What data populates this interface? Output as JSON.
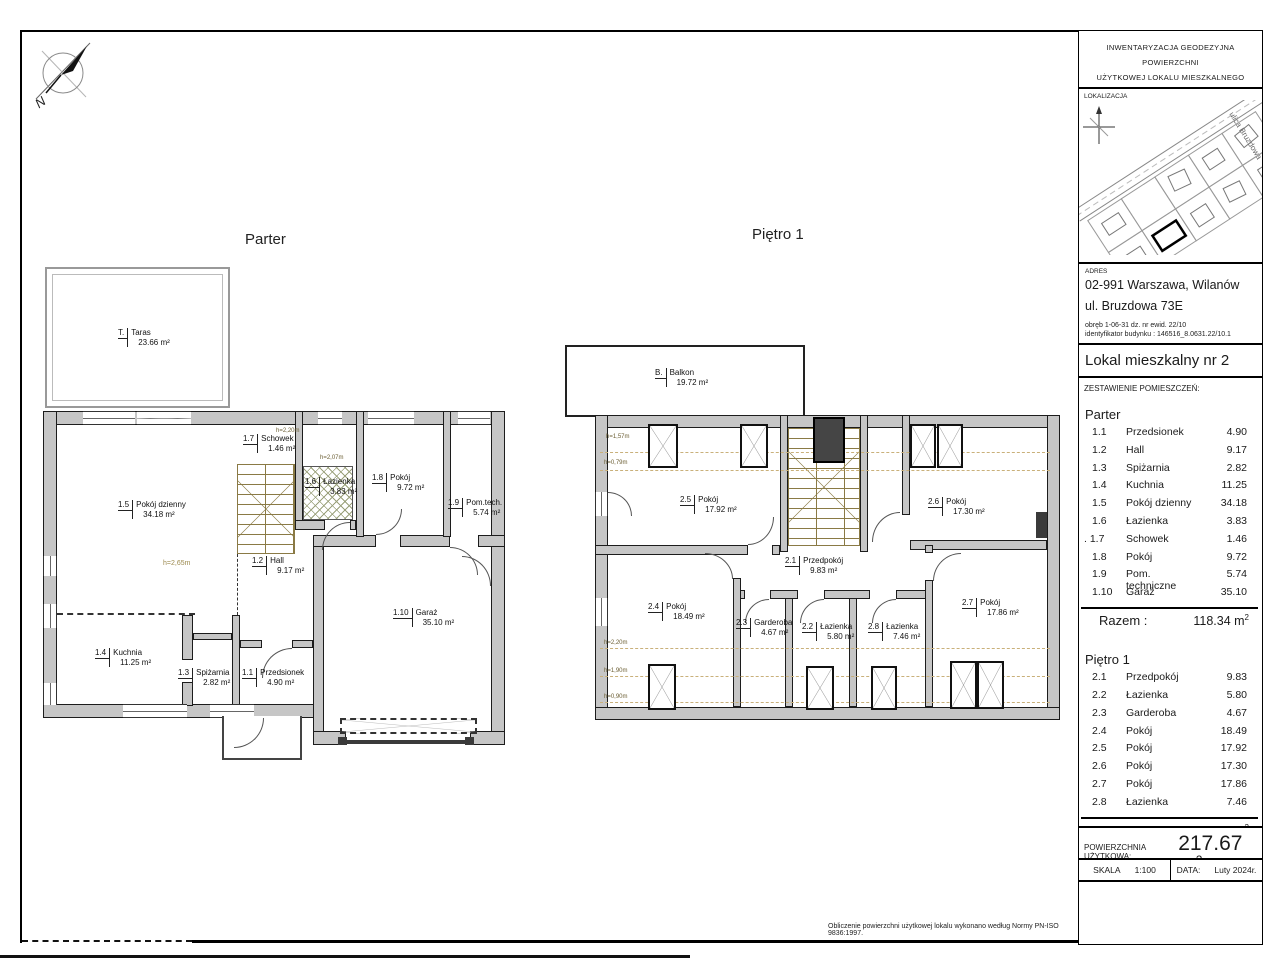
{
  "panel": {
    "header": {
      "line1": "INWENTARYZACJA GEODEZYJNA POWIERZCHNI",
      "line2": "UŻYTKOWEJ LOKALU MIESZKALNEGO"
    },
    "lokalizacja": {
      "label": "LOKALIZACJA",
      "street": "ulica Bruzdowa"
    },
    "adres": {
      "label": "ADRES",
      "city": "02-991 Warszawa, Wilanów",
      "street": "ul. Bruzdowa 73E",
      "obreb": "obręb 1-06-31 dz. nr ewid. 22/10",
      "building_id": "identyfikator budynku : 146516_8.0631.22/10.1"
    },
    "unit": {
      "label": "Lokal mieszkalny nr  2"
    },
    "rooms_summary": {
      "label": "ZESTAWIENIE POMIESZCZEŃ:",
      "floors": [
        {
          "name": "Parter",
          "razem_label": "Razem :",
          "razem_value": "118.34 m",
          "razem_sup": "2",
          "rooms": [
            {
              "num": "1.1",
              "name": "Przedsionek",
              "area": "4.90"
            },
            {
              "num": "1.2",
              "name": "Hall",
              "area": "9.17"
            },
            {
              "num": "1.3",
              "name": "Spiżarnia",
              "area": "2.82"
            },
            {
              "num": "1.4",
              "name": "Kuchnia",
              "area": "11.25"
            },
            {
              "num": "1.5",
              "name": "Pokój dzienny",
              "area": "34.18"
            },
            {
              "num": "1.6",
              "name": "Łazienka",
              "area": "3.83"
            },
            {
              "num": ". 1.7",
              "name": "Schowek",
              "area": "1.46"
            },
            {
              "num": "1.8",
              "name": "Pokój",
              "area": "9.72"
            },
            {
              "num": "1.9",
              "name": "Pom. techniczne",
              "area": "5.74"
            },
            {
              "num": "1.10",
              "name": "Garaż",
              "area": "35.10"
            }
          ]
        },
        {
          "name": "Piętro 1",
          "razem_label": "Razem :",
          "razem_value": "99.33 m",
          "razem_sup": "2",
          "rooms": [
            {
              "num": "2.1",
              "name": "Przedpokój",
              "area": "9.83"
            },
            {
              "num": "2.2",
              "name": "Łazienka",
              "area": "5.80"
            },
            {
              "num": "2.3",
              "name": "Garderoba",
              "area": "4.67"
            },
            {
              "num": "2.4",
              "name": "Pokój",
              "area": "18.49"
            },
            {
              "num": "2.5",
              "name": "Pokój",
              "area": "17.92"
            },
            {
              "num": "2.6",
              "name": "Pokój",
              "area": "17.30"
            },
            {
              "num": "2.7",
              "name": "Pokój",
              "area": "17.86"
            },
            {
              "num": "2.8",
              "name": "Łazienka",
              "area": "7.46"
            }
          ]
        }
      ]
    },
    "total": {
      "label": "POWIERZCHNIA UŻYTKOWA:",
      "value": "217.67 m",
      "sup": "2"
    },
    "meta": {
      "skala_label": "SKALA",
      "skala_value": "1:100",
      "data_label": "DATA:",
      "data_value": "Luty 2024r."
    }
  },
  "note": "Obliczenie powierzchni użytkowej lokalu wykonano według Normy PN-ISO 9836:1997.",
  "compass": {
    "n": "N"
  },
  "plans": {
    "parter": {
      "title": "Parter",
      "labels": [
        {
          "num": "T.",
          "name": "Taras",
          "area": "23.66 m²"
        },
        {
          "num": "1.5",
          "name": "Pokój dzienny",
          "area": "34.18 m²"
        },
        {
          "num": "1.7",
          "name": "Schowek",
          "area": "1.46 m²"
        },
        {
          "num": "1.6",
          "name": "Łazienka",
          "area": "3.83 m²"
        },
        {
          "num": "1.8",
          "name": "Pokój",
          "area": "9.72 m²"
        },
        {
          "num": "1.9",
          "name": "Pom.tech.",
          "area": "5.74 m²"
        },
        {
          "num": "1.2",
          "name": "Hall",
          "area": "9.17 m²"
        },
        {
          "num": "1.10",
          "name": "Garaż",
          "area": "35.10 m²"
        },
        {
          "num": "1.4",
          "name": "Kuchnia",
          "area": "11.25 m²"
        },
        {
          "num": "1.3",
          "name": "Spiżarnia",
          "area": "2.82 m²"
        },
        {
          "num": "1.1",
          "name": "Przedsionek",
          "area": "4.90 m²"
        }
      ],
      "h_labels": [
        "h=2,20m",
        "h=2,07m",
        "h=2,65m"
      ]
    },
    "pietro": {
      "title": "Piętro 1",
      "labels": [
        {
          "num": "B.",
          "name": "Balkon",
          "area": "19.72 m²"
        },
        {
          "num": "2.5",
          "name": "Pokój",
          "area": "17.92 m²"
        },
        {
          "num": "2.6",
          "name": "Pokój",
          "area": "17.30 m²"
        },
        {
          "num": "2.1",
          "name": "Przedpokój",
          "area": "9.83 m²"
        },
        {
          "num": "2.4",
          "name": "Pokój",
          "area": "18.49 m²"
        },
        {
          "num": "2.3",
          "name": "Garderoba",
          "area": "4.67 m²"
        },
        {
          "num": "2.2",
          "name": "Łazienka",
          "area": "5.80 m²"
        },
        {
          "num": "2.8",
          "name": "Łazienka",
          "area": "7.46 m²"
        },
        {
          "num": "2.7",
          "name": "Pokój",
          "area": "17.86 m²"
        }
      ],
      "h_labels": [
        "h=1,57m",
        "h=0,79m",
        "h=2,20m",
        "h=1,90m",
        "h=0,90m"
      ]
    }
  }
}
